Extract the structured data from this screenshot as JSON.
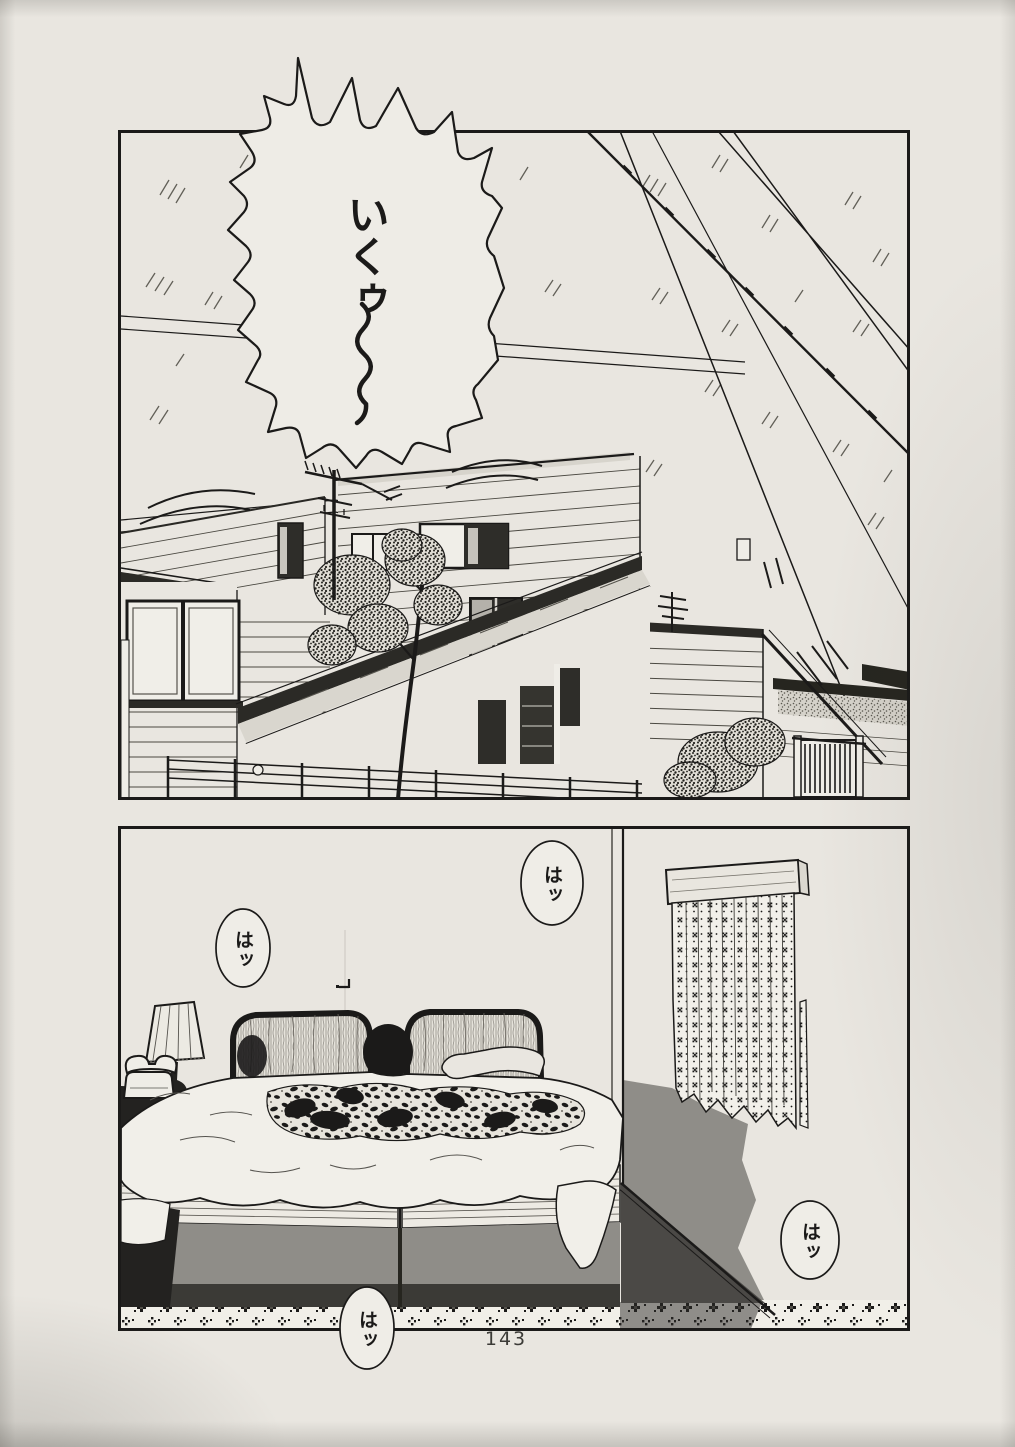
{
  "page_number": "143",
  "panel_1": {
    "name": "exterior street scene with houses and power lines",
    "balloon_iku": {
      "text": "いくゥ",
      "style": "burst",
      "wavy_tail": true
    }
  },
  "panel_2": {
    "name": "bedroom scene with twin beds, curtain and nightstand",
    "balloon_ha_top": {
      "text": "はッ"
    },
    "balloon_ha_left": {
      "text": "はッ"
    },
    "balloon_ha_right": {
      "text": "はッ"
    },
    "balloon_ha_bottom": {
      "text": "はッ"
    }
  },
  "colors": {
    "paper": "#e9e6e0",
    "ink": "#1b1a19",
    "wall_shadow": "#8f8d88",
    "bed_dark_band": "#3b3a36",
    "deep_shadow": "#232220"
  }
}
